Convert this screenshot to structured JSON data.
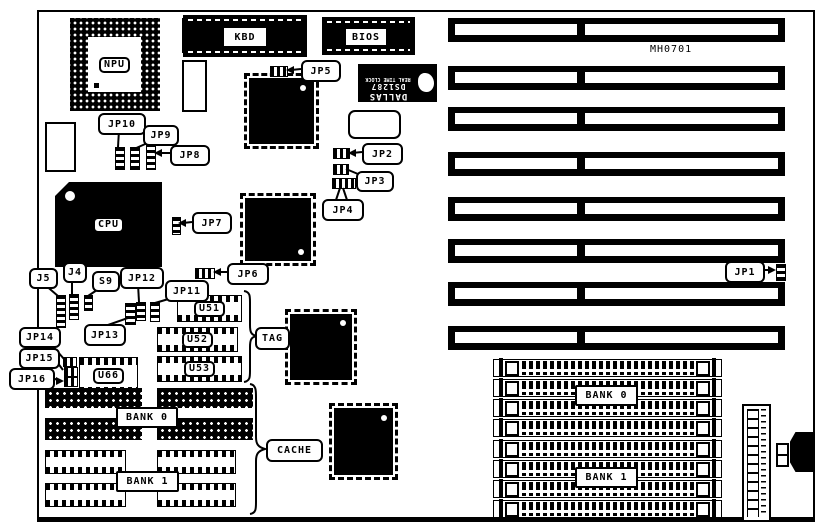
{
  "board": {
    "model": "MH0701",
    "isa_slot_count": 8,
    "simm_socket_count": 8
  },
  "labels": {
    "npu": "NPU",
    "cpu": "CPU",
    "kbd": "KBD",
    "bios": "BIOS",
    "jp1": "JP1",
    "jp2": "JP2",
    "jp3": "JP3",
    "jp4": "JP4",
    "jp5": "JP5",
    "jp6": "JP6",
    "jp7": "JP7",
    "jp8": "JP8",
    "jp9": "JP9",
    "jp10": "JP10",
    "jp11": "JP11",
    "jp12": "JP12",
    "jp13": "JP13",
    "jp14": "JP14",
    "jp15": "JP15",
    "jp16": "JP16",
    "j4": "J4",
    "j5": "J5",
    "s9": "S9",
    "u51": "U51",
    "u52": "U52",
    "u53": "U53",
    "u66": "U66",
    "tag": "TAG",
    "cache": "CACHE",
    "bank0": "BANK 0",
    "bank1": "BANK 1"
  },
  "dallas_chip": {
    "brand": "DALLAS",
    "part": "DS1287",
    "desc": "REAL TIME CLOCK"
  },
  "colors": {
    "ink": "#000000",
    "background": "#ffffff"
  }
}
